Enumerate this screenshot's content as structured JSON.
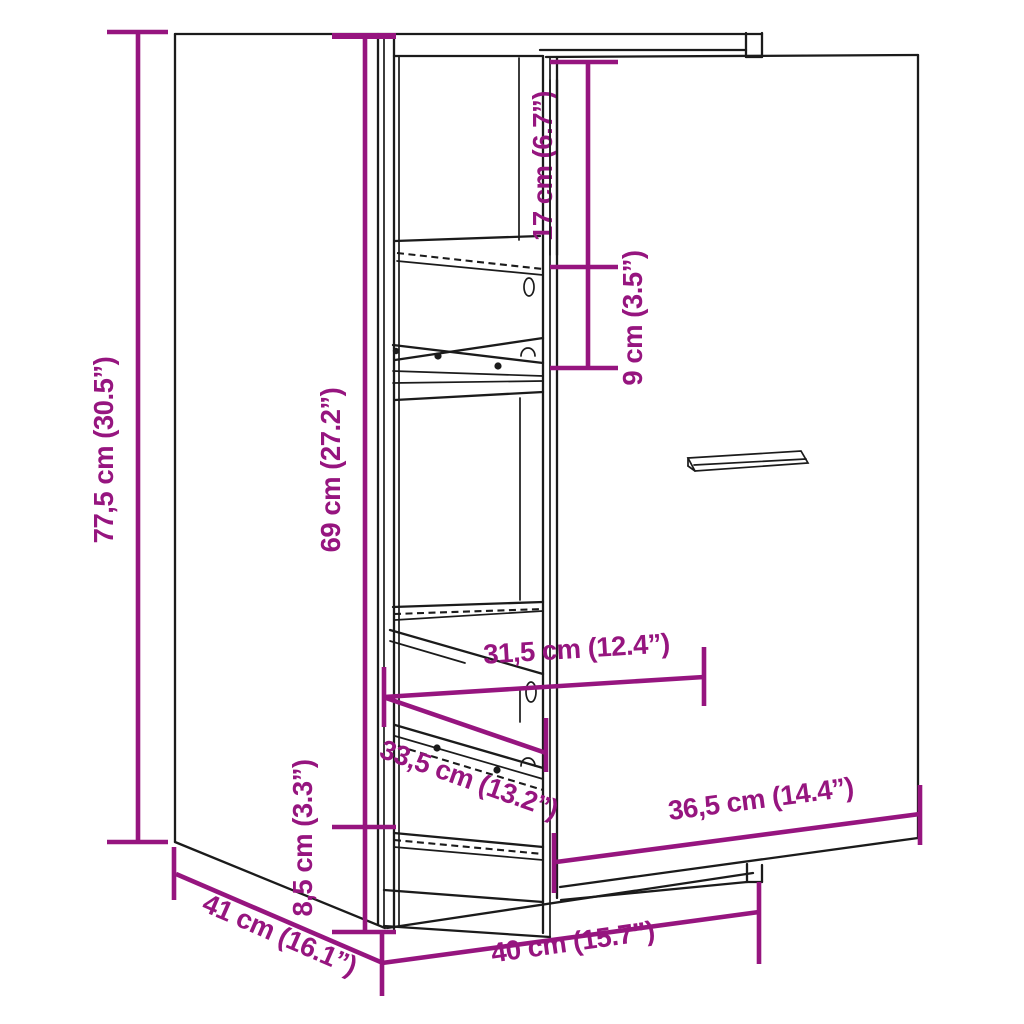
{
  "diagram": {
    "colors": {
      "dimension": "#96157F",
      "outline": "#1B1B1B",
      "background": "#FFFFFF"
    },
    "dimensions": {
      "overall_height": "77,5 cm (30.5”)",
      "interior_height": "69 cm (27.2”)",
      "plinth_height": "8,5 cm (3.3”)",
      "top_compartment_height": "17 cm (6.7”)",
      "second_compartment_height": "9 cm (3.5”)",
      "interior_width": "31,5 cm (12.4”)",
      "pullout_depth": "33,5 cm (13.2”)",
      "door_width": "36,5 cm (14.4”)",
      "overall_width": "40 cm (15.7”)",
      "overall_depth": "41 cm (16.1”)"
    }
  }
}
